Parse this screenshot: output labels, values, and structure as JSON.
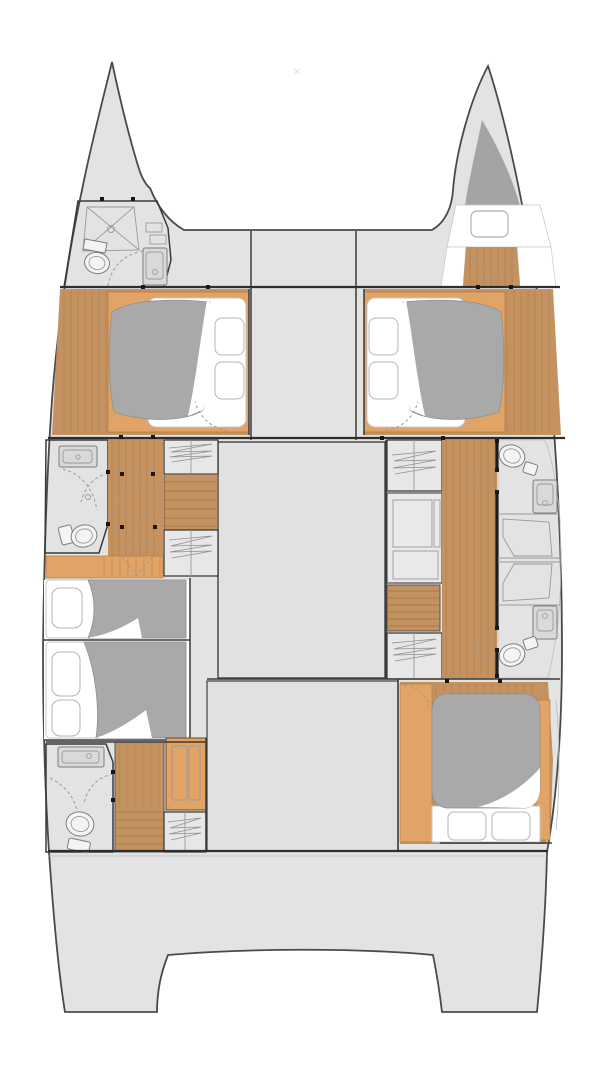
{
  "palette": {
    "page_bg": "#ffffff",
    "hull_deck": "#e3e3e3",
    "hull_outline": "#4a4a4a",
    "bridge_deck": "#e1e1e1",
    "room_floor": "#ececec",
    "cabinet_panel": "#e7e7e7",
    "desk_panel": "#e9e9e9",
    "wood_floor": "#c49261",
    "wood_accent": "#e2a367",
    "bed_linen": "#ffffff",
    "duvet_gray": "#a9a9a9",
    "forepeak_gray": "#a4a4a4",
    "sink_gray": "#d9d9d9",
    "fixture_white": "#f4f4f4",
    "shower_tray": "#e6e6e6",
    "shelf_gray": "#dedede",
    "wall_dark": "#3a3a3a",
    "wall_black": "#1c1c1c",
    "watermark_gray": "#dfdfdf"
  },
  "watermark": {
    "glyph": "×"
  }
}
